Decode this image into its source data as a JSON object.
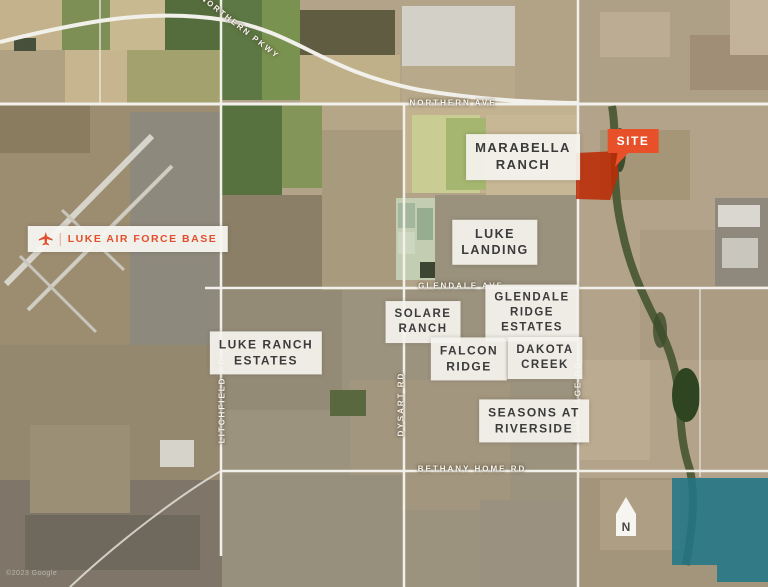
{
  "map": {
    "site": {
      "label": "SITE"
    },
    "poi": {
      "luke_afb": "LUKE AIR FORCE BASE"
    },
    "roads": {
      "northern_pkwy": "NORTHERN PKWY",
      "northern_ave": "NORTHERN AVE",
      "glendale_ave": "GLENDALE AVE",
      "bethany_home_rd": "BETHANY HOME RD",
      "litchfield_rd": "LITCHFIELD RD",
      "dysart_rd": "DYSART RD",
      "el_mirage_rd": "EL MIRAGE RD"
    },
    "places": {
      "marabella_ranch": {
        "line1": "MARABELLA",
        "line2": "RANCH"
      },
      "luke_landing": {
        "line1": "LUKE",
        "line2": "LANDING"
      },
      "glendale_ridge_estates": {
        "line1": "GLENDALE",
        "line2": "RIDGE",
        "line3": "ESTATES"
      },
      "solare_ranch": {
        "line1": "SOLARE",
        "line2": "RANCH"
      },
      "luke_ranch_estates": {
        "line1": "LUKE RANCH",
        "line2": "ESTATES"
      },
      "falcon_ridge": {
        "line1": "FALCON",
        "line2": "RIDGE"
      },
      "dakota_creek": {
        "line1": "DAKOTA",
        "line2": "CREEK"
      },
      "seasons_at_riverside": {
        "line1": "SEASONS AT",
        "line2": "RIVERSIDE"
      }
    },
    "compass": {
      "north": "N"
    },
    "attribution": "©2023 Google",
    "colors": {
      "site_accent": "#E8502A",
      "site_parcel": "#BC2B06",
      "afb_text": "#E0502D",
      "parcel_teal": "#20758A",
      "label_bg": "#F5F3EE",
      "label_text": "#3B3B3B",
      "road_text": "#FFFFFF"
    }
  }
}
